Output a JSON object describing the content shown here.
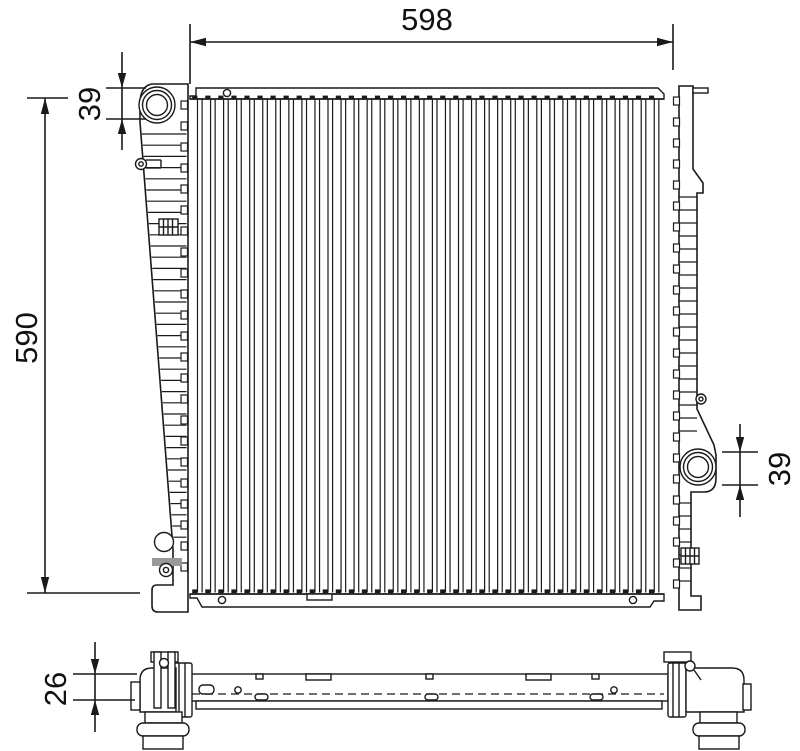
{
  "diagram": {
    "kind": "radiator-technical-drawing",
    "dimensions": {
      "overall_width": "598",
      "overall_height": "590",
      "inlet_offset": "39",
      "outlet_offset": "39",
      "core_thickness": "26"
    },
    "colors": {
      "line": "#1a1a1a",
      "background": "#ffffff",
      "drain_band": "#999999"
    }
  }
}
